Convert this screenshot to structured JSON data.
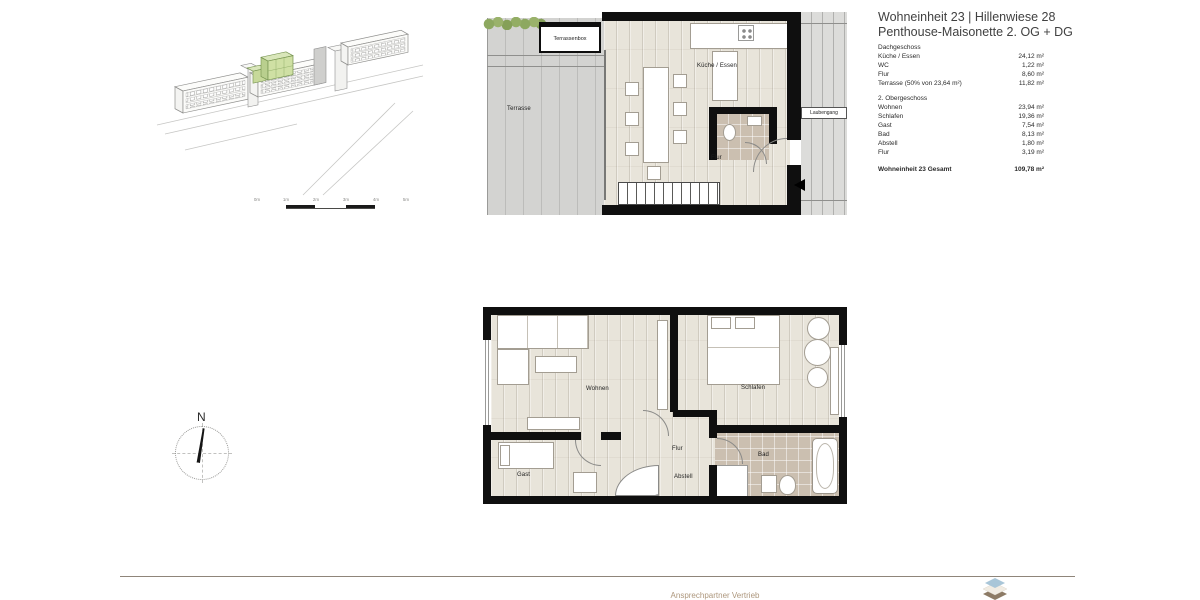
{
  "header": {
    "title_line1": "Wohneinheit 23 | Hillenwiese 28",
    "title_line2": "Penthouse-Maisonette 2. OG + DG"
  },
  "areas": {
    "section1": {
      "heading": "Dachgeschoss",
      "rows": [
        {
          "label": "Küche / Essen",
          "value": "24,12 m²"
        },
        {
          "label": "WC",
          "value": "1,22 m²"
        },
        {
          "label": "Flur",
          "value": "8,60 m²"
        },
        {
          "label": "Terrasse (50% von 23,64 m²)",
          "value": "11,82 m²"
        }
      ]
    },
    "section2": {
      "heading": "2. Obergeschoss",
      "rows": [
        {
          "label": "Wohnen",
          "value": "23,94 m²"
        },
        {
          "label": "Schlafen",
          "value": "19,36 m²"
        },
        {
          "label": "Gast",
          "value": "7,54 m²"
        },
        {
          "label": "Bad",
          "value": "8,13 m²"
        },
        {
          "label": "Abstell",
          "value": "1,80 m²"
        },
        {
          "label": "Flur",
          "value": "3,19 m²"
        }
      ]
    },
    "total": {
      "label": "Wohneinheit 23 Gesamt",
      "value": "109,78 m²"
    }
  },
  "plan_dg": {
    "terrassenbox": "Terrassenbox",
    "terrasse": "Terrasse",
    "kueche_essen": "Küche / Essen",
    "flur": "Flur",
    "laubengang": "Laubengang"
  },
  "plan_og": {
    "wohnen": "Wohnen",
    "schlafen": "Schlafen",
    "gast": "Gast",
    "flur": "Flur",
    "abstell": "Abstell",
    "bad": "Bad"
  },
  "compass": {
    "north": "N"
  },
  "scalebar": {
    "ticks": [
      "0m",
      "1m",
      "2m",
      "3m",
      "4m",
      "5m"
    ]
  },
  "footer": {
    "contact": "Ansprechpartner Vertrieb"
  },
  "colors": {
    "highlight_green": "#cfe0a4",
    "wall_black": "#0f0f0f",
    "wood_floor": "#e8e4da",
    "tile_floor": "#cbbfb0",
    "footer_text": "#ad977d",
    "logo_top": "#a9c6d8",
    "logo_mid": "#f1ece3",
    "logo_bottom": "#8d7b66"
  }
}
